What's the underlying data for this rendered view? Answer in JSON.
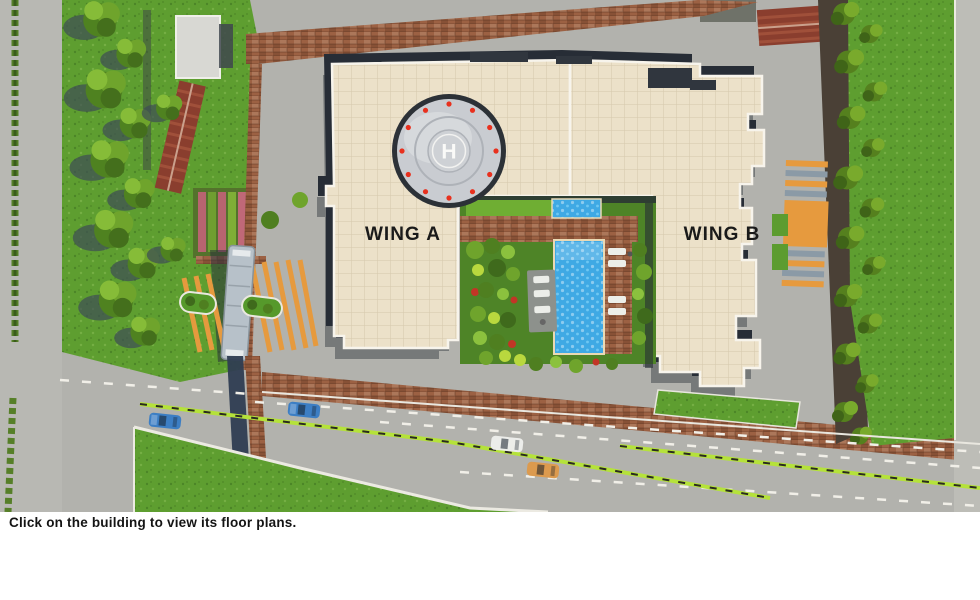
{
  "page": {
    "caption": "Click on the building to view its floor plans."
  },
  "site": {
    "wing_a": {
      "label": "WING A"
    },
    "wing_b": {
      "label": "WING B"
    },
    "helipad": {
      "letter": "H"
    }
  },
  "palette": {
    "road": "#b2b2ad",
    "road_light": "#bdbdb7",
    "grass": "#5e9e30",
    "brick": "#9c6143",
    "building": "#ece1c9",
    "edge_dark": "#272d36",
    "parapet": "#f7f4ec",
    "helipad_pad": "#c9ccd1",
    "helipad_dot": "#e8301e",
    "pool": "#3fa9e4",
    "pool_edge": "#ead9b4",
    "orange": "#e69a3e",
    "stripe_gray": "#8b9aa6",
    "divider_green": "#b5e23a",
    "car_blue": "#3c7ec4",
    "car_white": "#ecedea",
    "car_orange": "#dc9a4e",
    "canopy": "#b7c1c9",
    "label_color": "#1a1a1a"
  }
}
